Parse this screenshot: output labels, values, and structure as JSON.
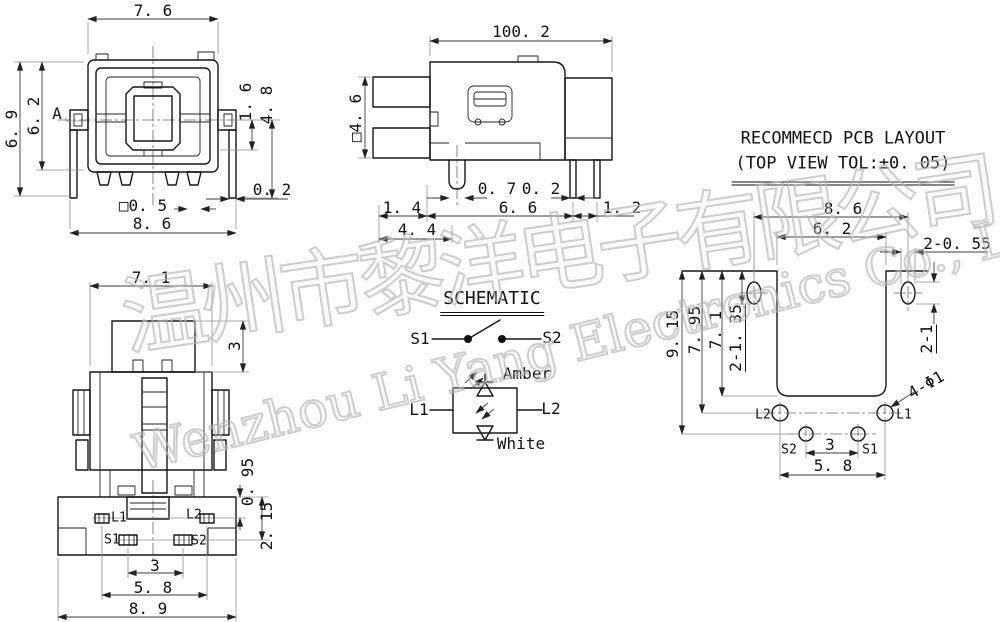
{
  "drawing": {
    "watermark": {
      "line1": "温州市黎洋电子有限公司",
      "line2": "Wenzhou Li Yang Electronics Co., Ltd."
    },
    "top_view": {
      "dim_width_top": "7. 6",
      "dim_height_outer": "6. 9",
      "dim_height_inner": "6. 2",
      "section_label": "A",
      "dim_right_upper": "1. 6",
      "dim_right_lower": "4. 8",
      "dim_pin_offset": "0. 2",
      "dim_pin_square": "□0. 5",
      "dim_width_bottom": "8. 6"
    },
    "side_view": {
      "dim_overall_width": "100. 2",
      "dim_shaft": "□4. 6",
      "dim_pin_width": "0. 7",
      "dim_leg_width": "0. 2",
      "dim_left": "1. 4",
      "dim_span": "6. 6",
      "dim_right": "1. 2",
      "dim_depth": "4. 4"
    },
    "front_view": {
      "dim_width": "7. 1",
      "dim_button_height": "3",
      "dim_led_row": "0. 95",
      "dim_switch_row": "2. 15",
      "dim_s_pitch": "3",
      "dim_l_pitch": "5. 8",
      "dim_overall_width": "8. 9",
      "pin_l1": "L1",
      "pin_l2": "L2",
      "pin_s1": "S1",
      "pin_s2": "S2"
    },
    "schematic": {
      "title": "SCHEMATIC",
      "s1": "S1",
      "s2": "S2",
      "l1": "L1",
      "l2": "L2",
      "led_top": "Amber",
      "led_bottom": "White"
    },
    "pcb_layout": {
      "title_line1": "RECOMMECD PCB LAYOUT",
      "title_line2": "(TOP VIEW TOL:±0. 05)",
      "dim_slot_pitch": "8. 6",
      "dim_body_width": "6. 2",
      "dim_slot_width": "2-0. 55",
      "dim_height_total": "9. 15",
      "dim_height_led": "7. 95",
      "dim_height_body": "7. 1",
      "dim_slot_length": "2-1. 35",
      "dim_slot_right": "2-1",
      "dim_holes": "4-Φ1",
      "dim_s_pitch": "3",
      "dim_l_pitch": "5. 8",
      "hole_l1": "L1",
      "hole_l2": "L2",
      "hole_s1": "S1",
      "hole_s2": "S2"
    }
  }
}
